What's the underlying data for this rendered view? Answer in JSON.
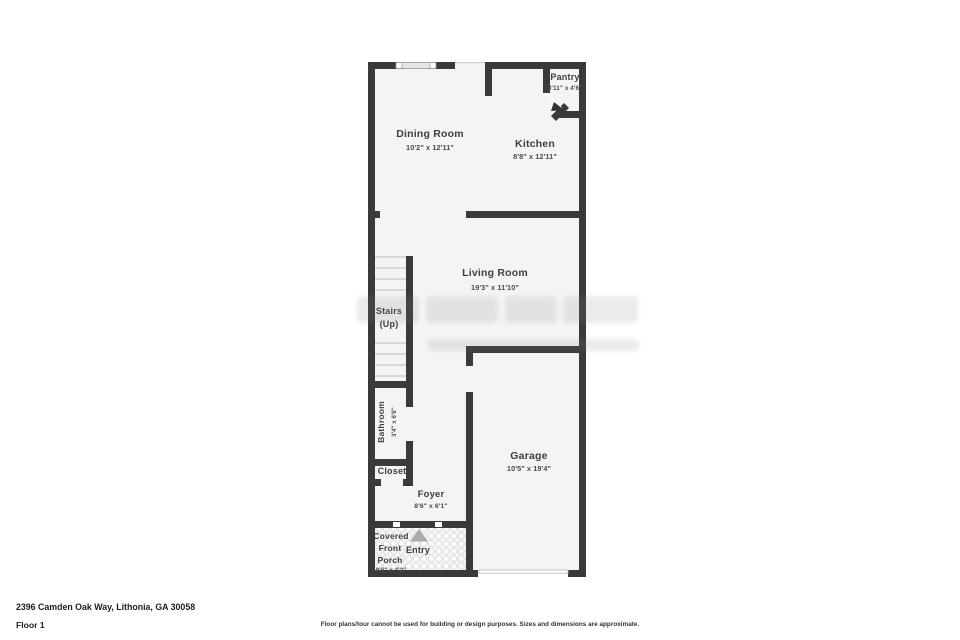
{
  "address": "2396 Camden Oak Way, Lithonia, GA 30058",
  "floor_label": "Floor 1",
  "disclaimer": "Floor plans/tour cannot be used for building or design purposes. Sizes and dimensions are approximate.",
  "rooms": {
    "pantry": {
      "name": "Pantry",
      "dims": "3'11\" x 4'6\""
    },
    "dining": {
      "name": "Dining Room",
      "dims": "10'2\" x 12'11\""
    },
    "kitchen": {
      "name": "Kitchen",
      "dims": "8'8\" x 12'11\""
    },
    "living": {
      "name": "Living Room",
      "dims": "19'3\" x 11'10\""
    },
    "stairs": {
      "name": "Stairs",
      "direction": "(Up)"
    },
    "bathroom": {
      "name": "Bathroom",
      "dims": "3'4\" x 6'8\""
    },
    "closet": {
      "name": "Closet"
    },
    "foyer": {
      "name": "Foyer",
      "dims": "8'6\" x 6'1\""
    },
    "garage": {
      "name": "Garage",
      "dims": "10'5\" x 19'4\""
    },
    "porch": {
      "name_line1": "Covered",
      "name_line2": "Front",
      "name_line3": "Porch",
      "dims": "8'6\" x 4'2\""
    },
    "entry": {
      "name": "Entry"
    }
  },
  "colors": {
    "wall": "#3a3a3a",
    "floor": "#f4f4f4",
    "entry_arrow": "#a9a9a9"
  }
}
